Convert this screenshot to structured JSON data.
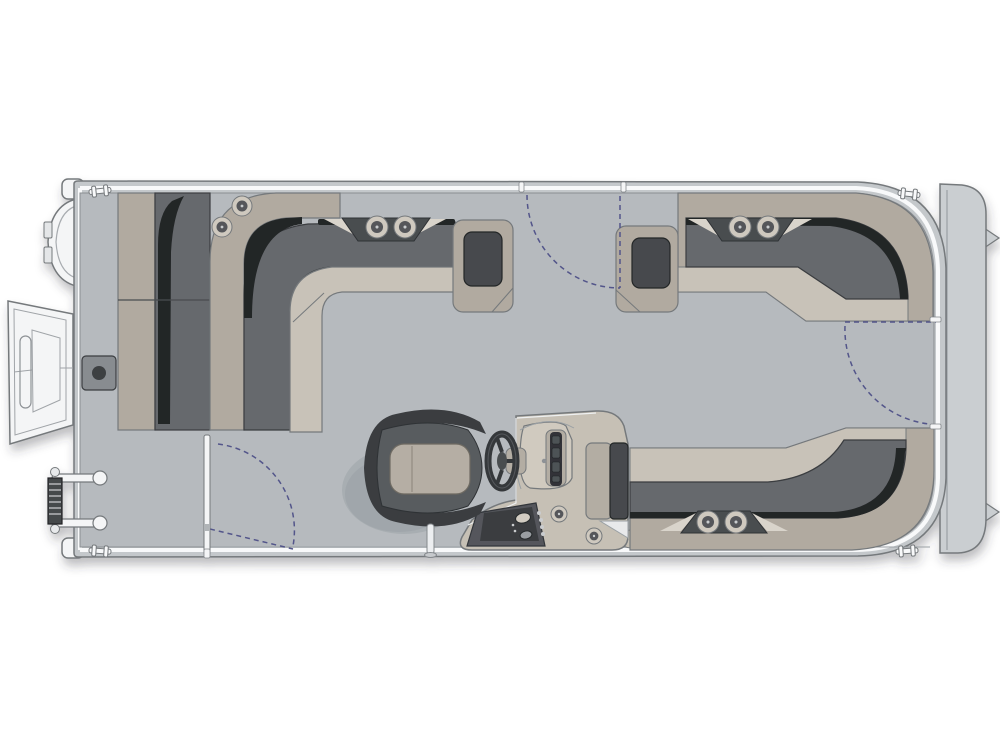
{
  "app": {
    "description": "Top-down pontoon boat floor plan diagram showing bow boarding ramp and ladder, two forward L-shaped lounges, helm console with steering wheel, captain's chair, stern L-shaped lounge, three gates with swing arcs, and rear platform"
  },
  "palette": {
    "background": "#ffffff",
    "outline": "#75797c",
    "outline_dark": "#3a3d40",
    "fence": "#c4c8cb",
    "platform": "#caced1",
    "rub_rail": "#f8f9fa",
    "deck": "#b6babe",
    "seat_back": "#b1aaa0",
    "seat_front": "#c8c2b8",
    "cushion": "#66696d",
    "cushion_shadow": "#232527",
    "armrest_inner": "#474a4e",
    "trapezoid": "#4a4d50",
    "wing": "#d9d4cb",
    "console_body": "#c6c0b5",
    "console_pod": "#d0cabf",
    "console_panel": "#54575b",
    "console_panel_dark": "#3a3d41",
    "screen_dark": "#303337",
    "chair_shell": "#3a3d40",
    "chair_mid": "#585b5f",
    "chair_cushion": "#b5aea4",
    "gate": "#52558a",
    "white_part": "#f4f5f6",
    "fitting": "#888c90",
    "fitting_dark": "#3c3f43",
    "cup_ring": "#cfc9bf",
    "cup_inner": "#54575a",
    "cup_dot": "#c9ccce",
    "metal": "#b3ada3",
    "shadow": "#8d9499"
  },
  "features": {
    "zones": {
      "bow_couch": {
        "label": "Bow side couch (port bow, forward facing)"
      },
      "upper_left_lounge": {
        "label": "Forward L-shaped lounge with armrest",
        "cupholders": 4
      },
      "upper_right_lounge": {
        "label": "Forward starboard L-shaped lounge with armrest",
        "cupholders": 2
      },
      "stern_lounge": {
        "label": "Aft L-shaped lounge with armrest",
        "cupholders": 2
      },
      "helm": {
        "label": "Helm console",
        "items": [
          "steering-wheel",
          "dash-panel",
          "switch-panel",
          "cupholder",
          "cupholder"
        ]
      },
      "captain_chair": {
        "label": "Captain's high-back helm chair"
      },
      "bow_items": [
        "boarding-ramp",
        "boarding-ladder",
        "bow-bumper",
        "table-mount"
      ],
      "rear_platform": {
        "label": "Stern platform with motor-mount tabs"
      }
    },
    "gates": [
      {
        "id": "bow-side-gate",
        "label": "Bow side gate shown open with swing arc"
      },
      {
        "id": "midship-gate",
        "label": "Forward side gate swing arc"
      },
      {
        "id": "stern-gate",
        "label": "Stern gate opening to rear platform"
      }
    ],
    "cupholders": [
      {
        "x": 242,
        "y": 206,
        "r": 10
      },
      {
        "x": 222,
        "y": 227,
        "r": 10
      },
      {
        "x": 377,
        "y": 227,
        "r": 11
      },
      {
        "x": 405,
        "y": 227,
        "r": 11
      },
      {
        "x": 740,
        "y": 227,
        "r": 11
      },
      {
        "x": 768,
        "y": 227,
        "r": 11
      },
      {
        "x": 708,
        "y": 522,
        "r": 11
      },
      {
        "x": 736,
        "y": 522,
        "r": 11
      },
      {
        "x": 559,
        "y": 514,
        "r": 8
      },
      {
        "x": 594,
        "y": 536,
        "r": 8
      }
    ],
    "cleats": [
      {
        "x": 100,
        "y": 191,
        "a": -6
      },
      {
        "x": 909,
        "y": 194,
        "a": 6
      },
      {
        "x": 100,
        "y": 551,
        "a": 4
      },
      {
        "x": 907,
        "y": 551,
        "a": -4
      }
    ]
  }
}
